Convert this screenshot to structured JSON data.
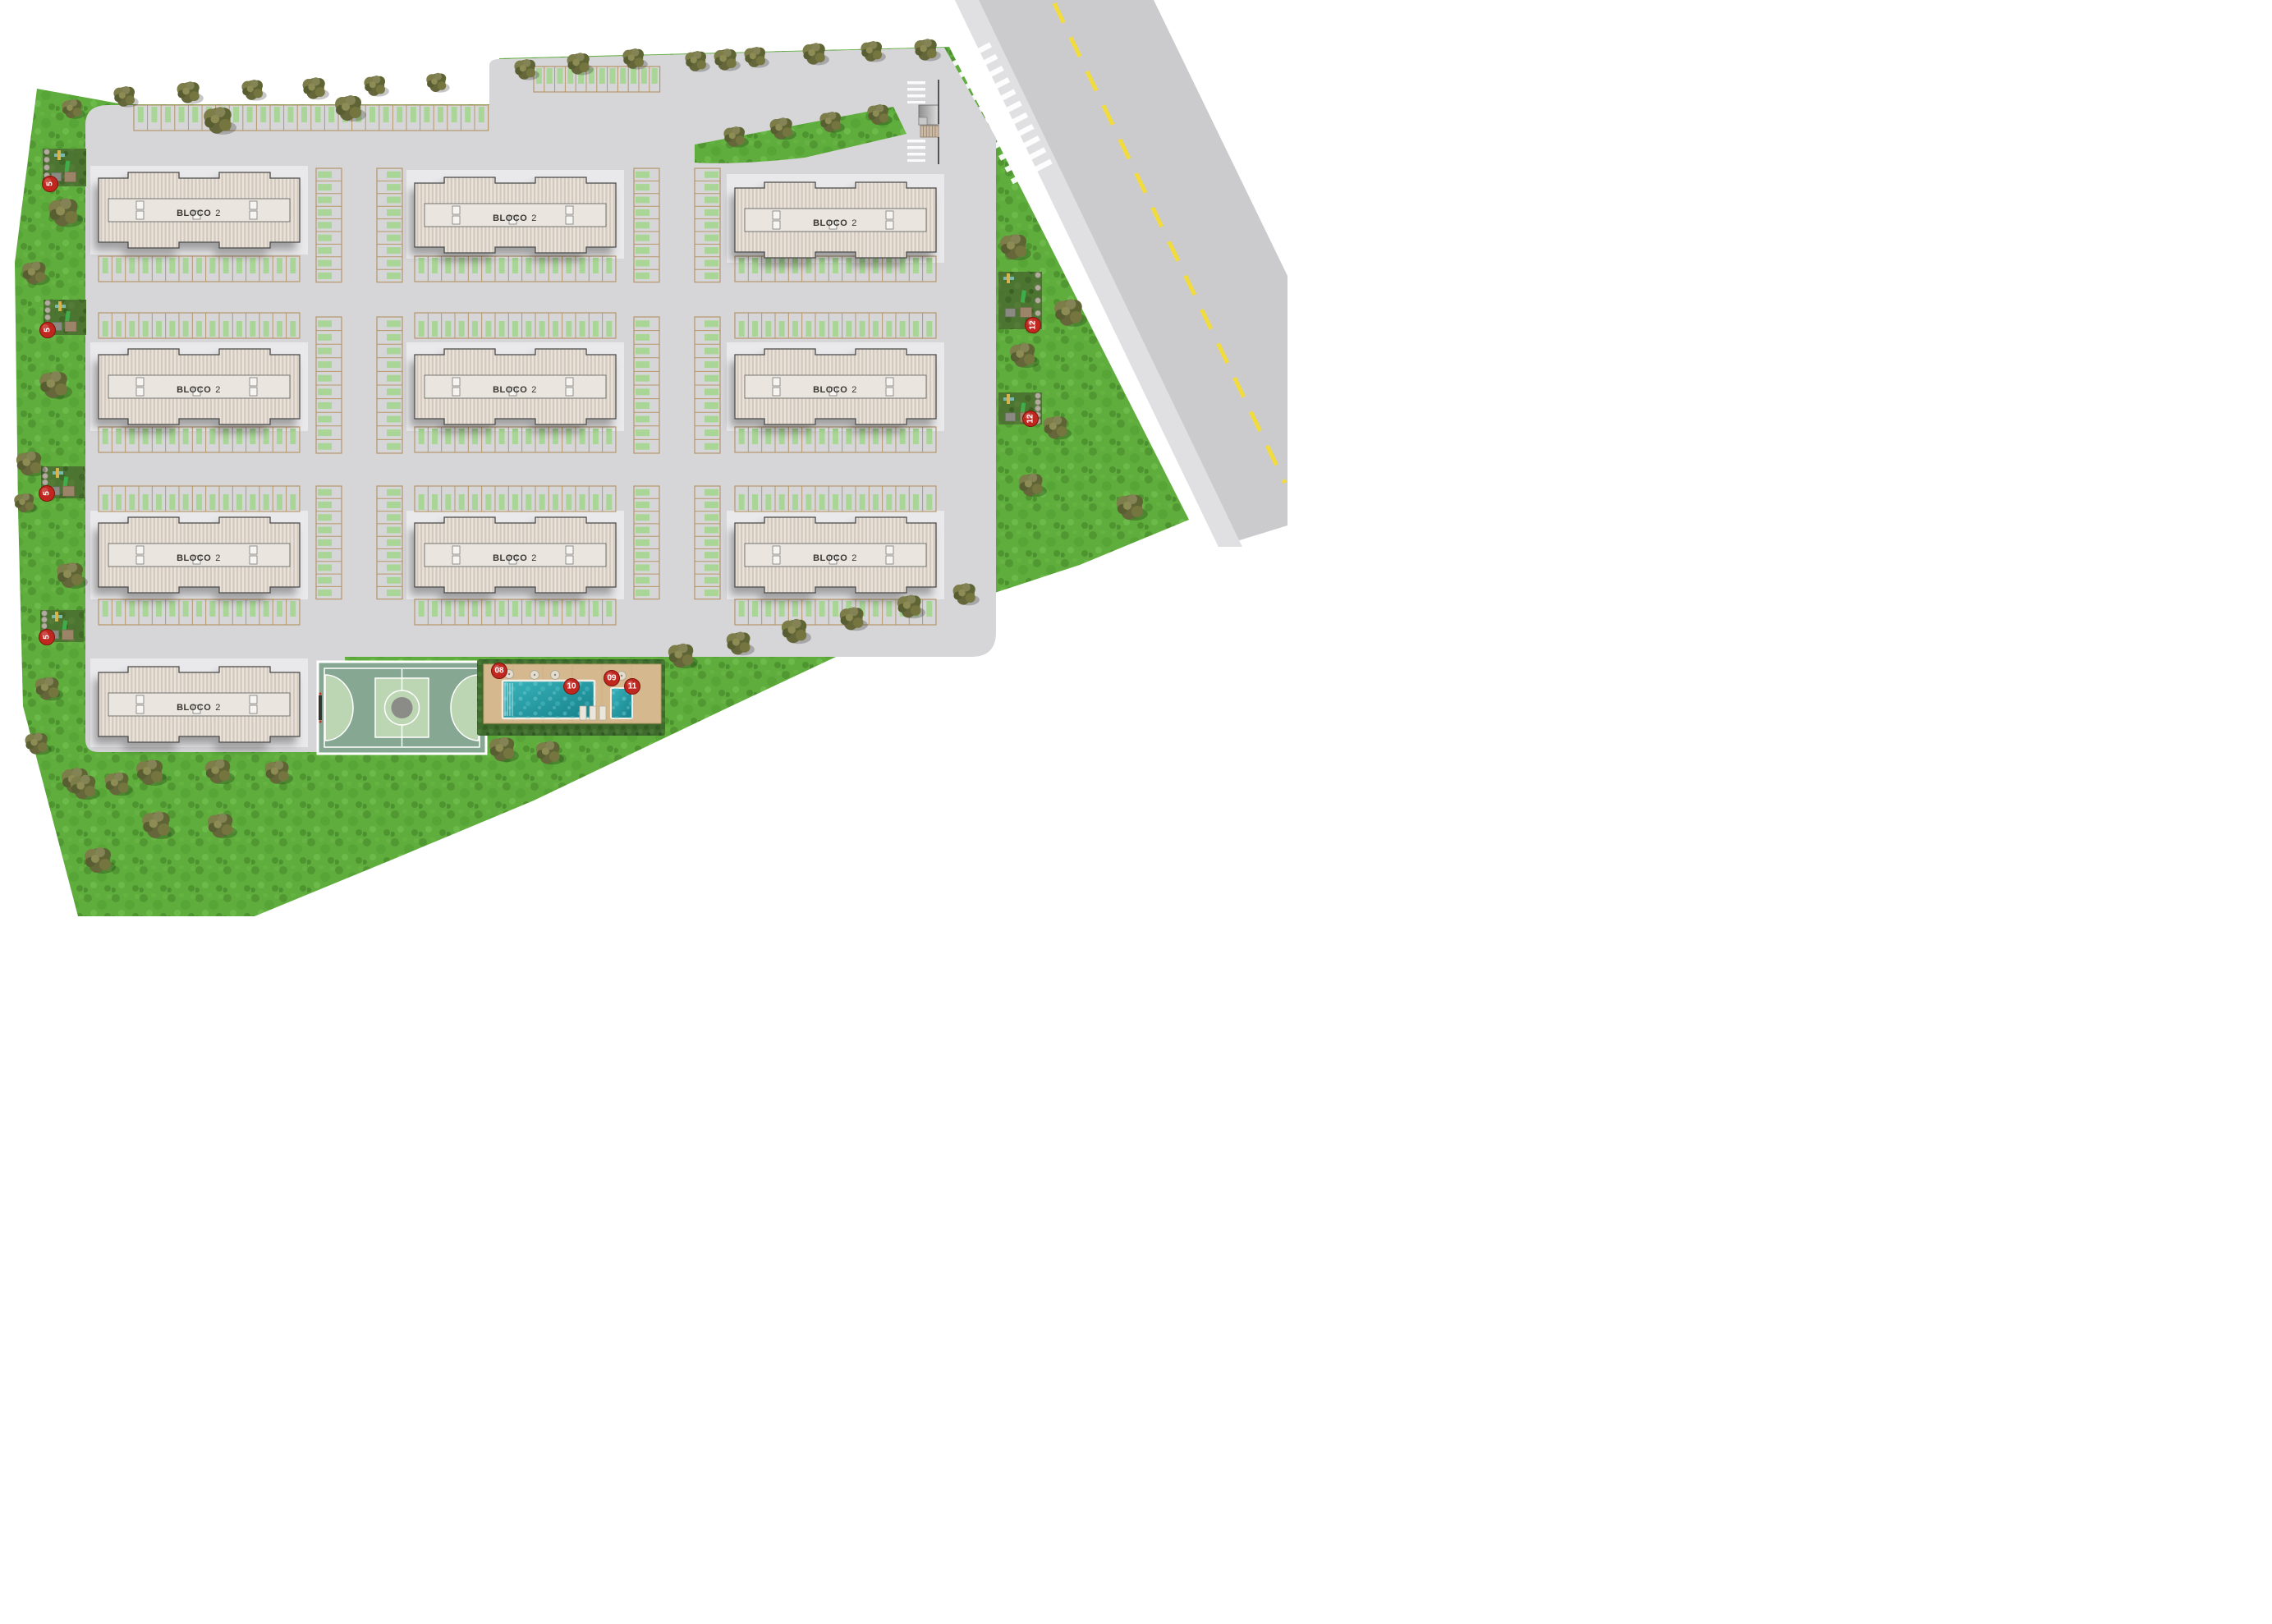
{
  "plan": {
    "kind": "condominium-site-plan"
  },
  "buildings": [
    {
      "name": "BLOCO",
      "number": "2"
    },
    {
      "name": "BLOCO",
      "number": "2"
    },
    {
      "name": "BLOCO",
      "number": "2"
    },
    {
      "name": "BLOCO",
      "number": "2"
    },
    {
      "name": "BLOCO",
      "number": "2"
    },
    {
      "name": "BLOCO",
      "number": "2"
    },
    {
      "name": "BLOCO",
      "number": "2"
    },
    {
      "name": "BLOCO",
      "number": "2"
    },
    {
      "name": "BLOCO",
      "number": "2"
    },
    {
      "name": "BLOCO",
      "number": "2"
    }
  ],
  "markers": {
    "pool_deck": [
      {
        "label": "08"
      },
      {
        "label": "09"
      },
      {
        "label": "10"
      },
      {
        "label": "11"
      }
    ],
    "left_edge": [
      {
        "label": "5"
      },
      {
        "label": "5"
      },
      {
        "label": "5"
      },
      {
        "label": "5"
      }
    ],
    "right_edge": [
      {
        "label": "12"
      },
      {
        "label": "12"
      }
    ]
  },
  "colors": {
    "grass": "#5fae3d",
    "pavement": "#d6d6d8",
    "road": "#cbcbcd",
    "road_center_line": "#f2dc3c",
    "stall_outline": "#b6976b",
    "stall_green": "#a9d696",
    "building_roof_light": "#eae3da",
    "building_roof_dark": "#d3c9bf",
    "court_dark": "#86a893",
    "court_light": "#bcd5b3",
    "pool_deck": "#d5b88e",
    "water": "#2ba6ad",
    "hedge": "#3e6b2d",
    "marker_red": "#c0271f"
  },
  "icons": {
    "tree": "tree-icon",
    "parasol": "parasol-icon",
    "lounger": "lounger-icon",
    "marker": "numbered-marker-icon",
    "crosswalk": "crosswalk-icon",
    "stairs": "stairs-icon"
  }
}
